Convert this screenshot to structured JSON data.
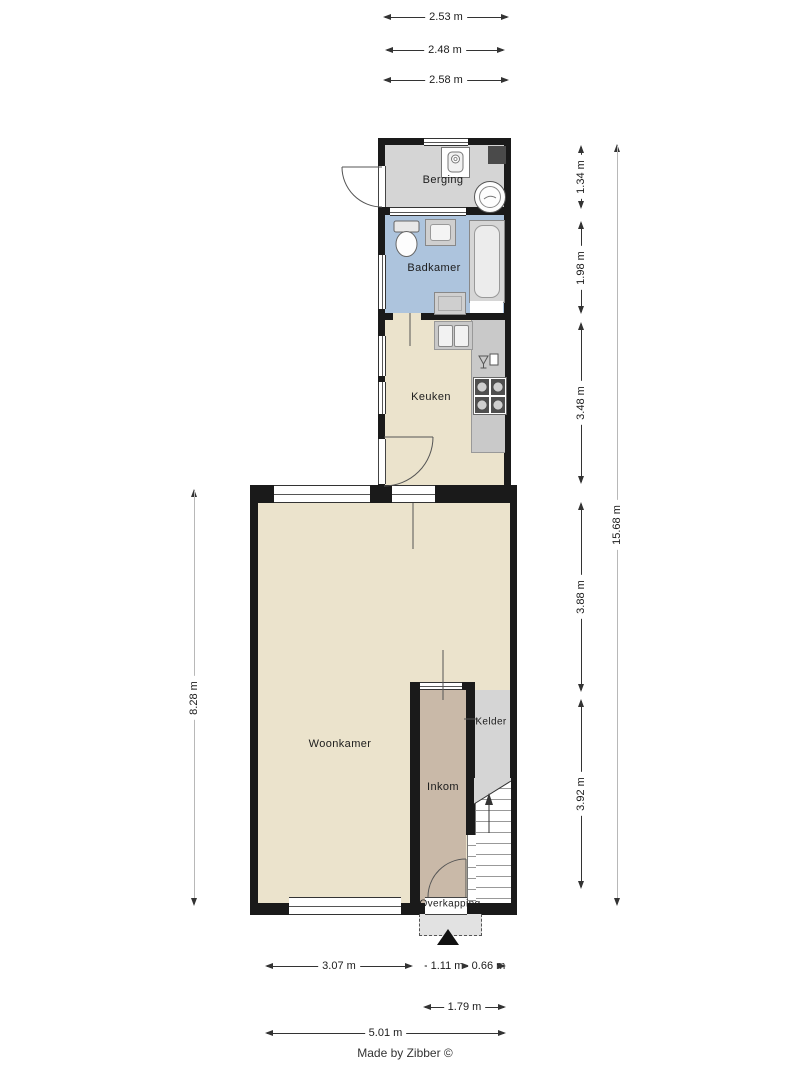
{
  "credit": "Made by Zibber ©",
  "rooms": {
    "berging": "Berging",
    "badkamer": "Badkamer",
    "keuken": "Keuken",
    "woonkamer": "Woonkamer",
    "inkom": "Inkom",
    "kelder": "Kelder",
    "overkapping": "Overkapping"
  },
  "dims": {
    "top": [
      "2.53 m",
      "2.48 m",
      "2.58 m"
    ],
    "right": [
      "1.34 m",
      "1.98 m",
      "3.48 m",
      "3.88 m",
      "3.92 m"
    ],
    "right_total": "15.68 m",
    "left_total": "8.28 m",
    "bottom_row1": [
      "3.07 m",
      "1.11 m",
      "0.66 m"
    ],
    "bottom_row2": [
      "1.79 m"
    ],
    "bottom_row3": [
      "5.01 m"
    ]
  },
  "icons": {
    "north_arrow": "filled-up-triangle",
    "washing_machine": "box-with-rounded-drum",
    "boiler": "double-circle",
    "toilet": "tank-and-bowl",
    "washbasin": "inset-rectangle",
    "bathtub": "inset-rounded-rectangle",
    "kitchen_sink": "double-basin",
    "tap": "glass-and-box",
    "stove": "four-burners",
    "stairs": "treads-with-up-arrow",
    "door": "quarter-arc"
  },
  "colors": {
    "wall": "#1a1a1a",
    "floor": "#ebe3cc",
    "bathroom_floor": "#adc4dd",
    "storage_floor": "#d5d5d5",
    "hall_floor": "#c9b9a8",
    "counter": "#c9c9c9",
    "dark_fixture": "#4a4a4a",
    "dim_line": "#333333",
    "dim_total_line": "#b8b8b8"
  }
}
